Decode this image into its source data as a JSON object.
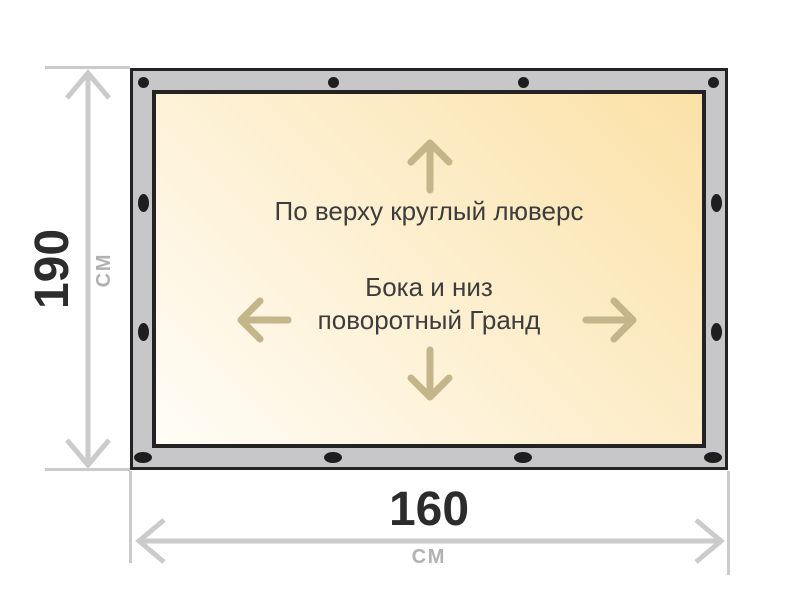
{
  "diagram": {
    "title": "Banner size and fastening scheme",
    "notes": {
      "top_edge": "По верху круглый люверс",
      "sides_line1": "Бока и низ",
      "sides_line2": "поворотный Гранд"
    },
    "dimensions": {
      "height": {
        "value": "190",
        "unit": "см"
      },
      "width": {
        "value": "160",
        "unit": "см"
      }
    },
    "colors": {
      "frame": "#c7c7c9",
      "frame_border": "#232323",
      "grommet": "#1e1e1e",
      "canvas_light": "#fffdf7",
      "canvas_cream": "#fbe1a7",
      "dimension": "#cbcbcb",
      "inner_arrow": "#c4b58b",
      "number_text": "#2c2c2c",
      "unit_text": "#b1b1b1",
      "note_text": "#3d3d3d"
    }
  }
}
